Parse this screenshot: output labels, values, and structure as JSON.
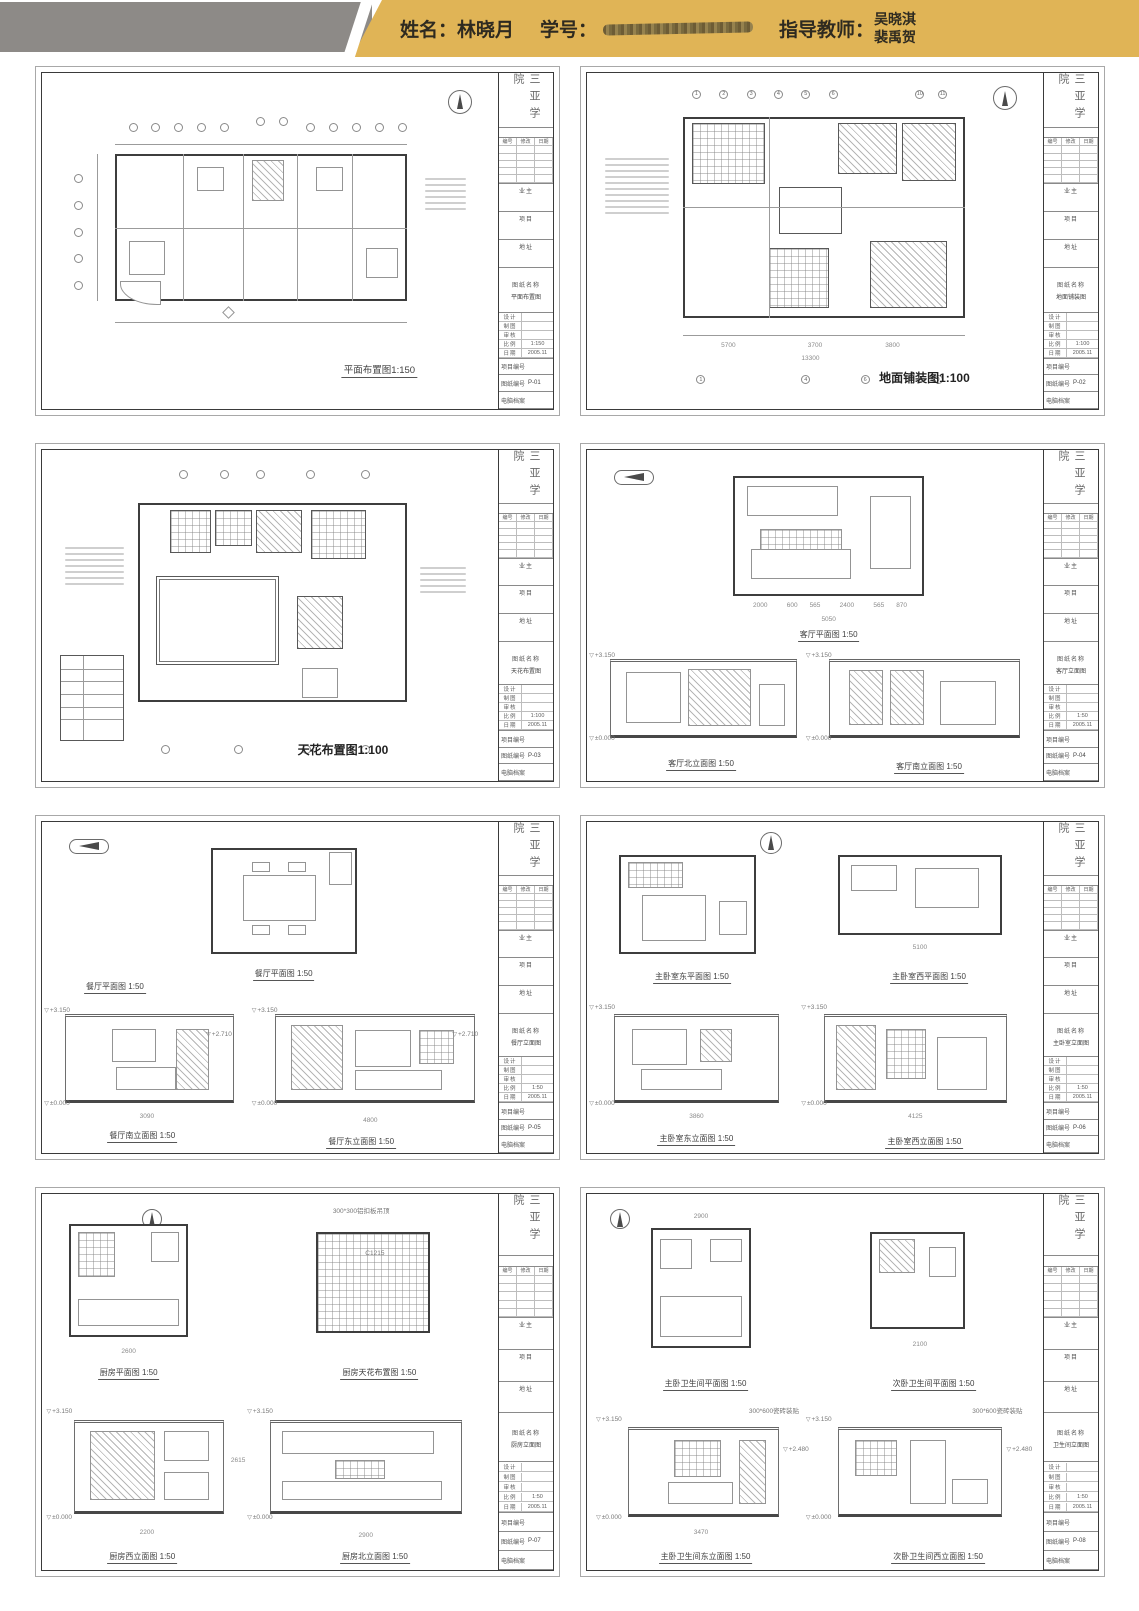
{
  "header": {
    "name_label": "姓名：",
    "name_value": "林晓月",
    "student_id_label": "学号：",
    "advisor_label": "指导教师：",
    "advisors": [
      "吴晓淇",
      "裴禹贺"
    ],
    "colors": {
      "gold": "#e0b456",
      "gray": "#8d8a87"
    }
  },
  "title_block": {
    "school": "三亚学院",
    "rev_headers": [
      "编号",
      "修改",
      "日期"
    ],
    "owner_label": "业主",
    "project_label": "项目",
    "address_label": "地址",
    "drawing_name_label": "图纸名称",
    "info_rows": [
      "设计",
      "制图",
      "审核",
      "比例",
      "日期"
    ],
    "project_no_label": "项目编号",
    "sheet_no_label": "图纸编号",
    "archive_label": "电脑档案"
  },
  "sheets": [
    {
      "name": "平面布置图",
      "captions": [
        "平面布置图1:150"
      ],
      "scale": "1:150",
      "date": "2005.11",
      "sheet_no": "P-01",
      "dims": [],
      "levels": [],
      "notes": []
    },
    {
      "name": "地面铺装图",
      "captions": [
        "地面铺装图1:100"
      ],
      "scale": "1:100",
      "date": "2005.11",
      "sheet_no": "P-02",
      "axes_top": [
        "1",
        "2",
        "3",
        "4",
        "5",
        "6",
        "10",
        "11"
      ],
      "axes_bottom": [
        "1",
        "4",
        "6",
        "9"
      ],
      "dims": [
        "5700",
        "3700",
        "3800",
        "13300"
      ],
      "levels": [],
      "notes": []
    },
    {
      "name": "天花布置图",
      "captions": [
        "天花布置图1:100"
      ],
      "scale": "1:100",
      "date": "2005.11",
      "sheet_no": "P-03",
      "dims": [],
      "levels": [],
      "notes": []
    },
    {
      "name": "客厅立面图",
      "captions": [
        "客厅平面图 1:50",
        "客厅北立面图 1:50",
        "客厅南立面图 1:50"
      ],
      "scale": "1:50",
      "date": "2005.11",
      "sheet_no": "P-04",
      "dims": [
        "2000",
        "600",
        "565",
        "2400",
        "565",
        "870",
        "5050"
      ],
      "levels": [
        "+3.150",
        "±0.000"
      ],
      "notes": []
    },
    {
      "name": "餐厅立面图",
      "captions": [
        "餐厅平面图 1:50",
        "餐厅平面图 1:50",
        "餐厅南立面图 1:50",
        "餐厅东立面图 1:50"
      ],
      "scale": "1:50",
      "date": "2005.11",
      "sheet_no": "P-05",
      "dims": [
        "3090",
        "4800"
      ],
      "levels": [
        "+3.150",
        "+2.710",
        "±0.000"
      ],
      "notes": []
    },
    {
      "name": "主卧室立面图",
      "captions": [
        "主卧室东平面图 1:50",
        "主卧室西平面图 1:50",
        "主卧室东立面图 1:50",
        "主卧室西立面图 1:50"
      ],
      "scale": "1:50",
      "date": "2005.11",
      "sheet_no": "P-06",
      "dims": [
        "5100",
        "3860",
        "4125"
      ],
      "levels": [
        "+3.150",
        "±0.000"
      ],
      "notes": []
    },
    {
      "name": "厨房立面图",
      "captions": [
        "厨房平面图 1:50",
        "厨房天花布置图 1:50",
        "厨房西立面图 1:50",
        "厨房北立面图 1:50"
      ],
      "scale": "1:50",
      "date": "2005.11",
      "sheet_no": "P-07",
      "dims": [
        "2600",
        "2615",
        "2200",
        "2900"
      ],
      "levels": [
        "+3.150",
        "±0.000"
      ],
      "notes": [
        "300*300铝扣板吊顶",
        "C1215"
      ]
    },
    {
      "name": "卫生间立面图",
      "captions": [
        "主卧卫生间平面图 1:50",
        "次卧卫生间平面图 1:50",
        "主卧卫生间东立面图 1:50",
        "次卧卫生间西立面图 1:50"
      ],
      "scale": "1:50",
      "date": "2005.11",
      "sheet_no": "P-08",
      "dims": [
        "2900",
        "2100",
        "3470"
      ],
      "levels": [
        "+3.150",
        "+2.480",
        "±0.000"
      ],
      "notes": [
        "300*600瓷砖装贴"
      ]
    }
  ]
}
